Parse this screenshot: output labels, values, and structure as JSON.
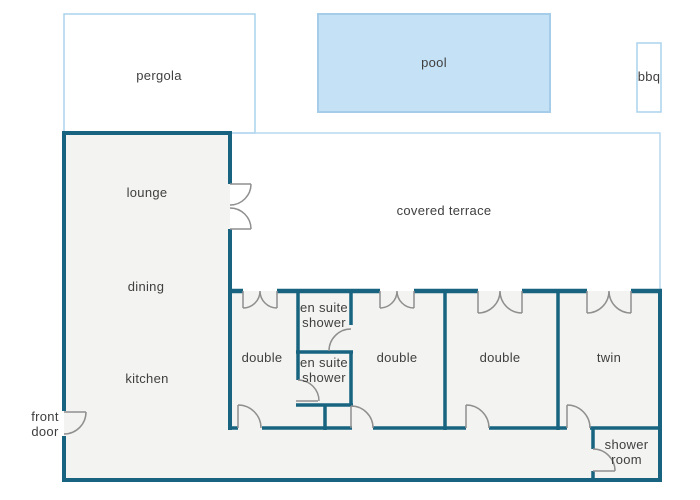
{
  "title": "house floor plan",
  "outdoor": {
    "pergola_label": "pergola",
    "pool_label": "pool",
    "bbq_label": "bbq"
  },
  "rooms": {
    "lounge": "lounge",
    "dining": "dining",
    "kitchen": "kitchen",
    "covered_terrace": "covered terrace",
    "bedroom1": "double",
    "ensuite_top": "en suite shower",
    "ensuite_bottom": "en suite shower",
    "bedroom2": "double",
    "bedroom3": "double",
    "twin": "twin",
    "shower_room": "shower room"
  },
  "annotations": {
    "front_door": "front door"
  },
  "colors": {
    "wall": "#186480",
    "floor": "#f3f3f1",
    "pool_fill": "#c5e1f6",
    "pool_stroke": "#a5cdea",
    "outdoor_outline": "#abd3ee",
    "terrace_outline": "#b5d8f1",
    "door_symbol": "#8f8f8f",
    "label_text": "#3f3f3f",
    "background": "#ffffff"
  }
}
